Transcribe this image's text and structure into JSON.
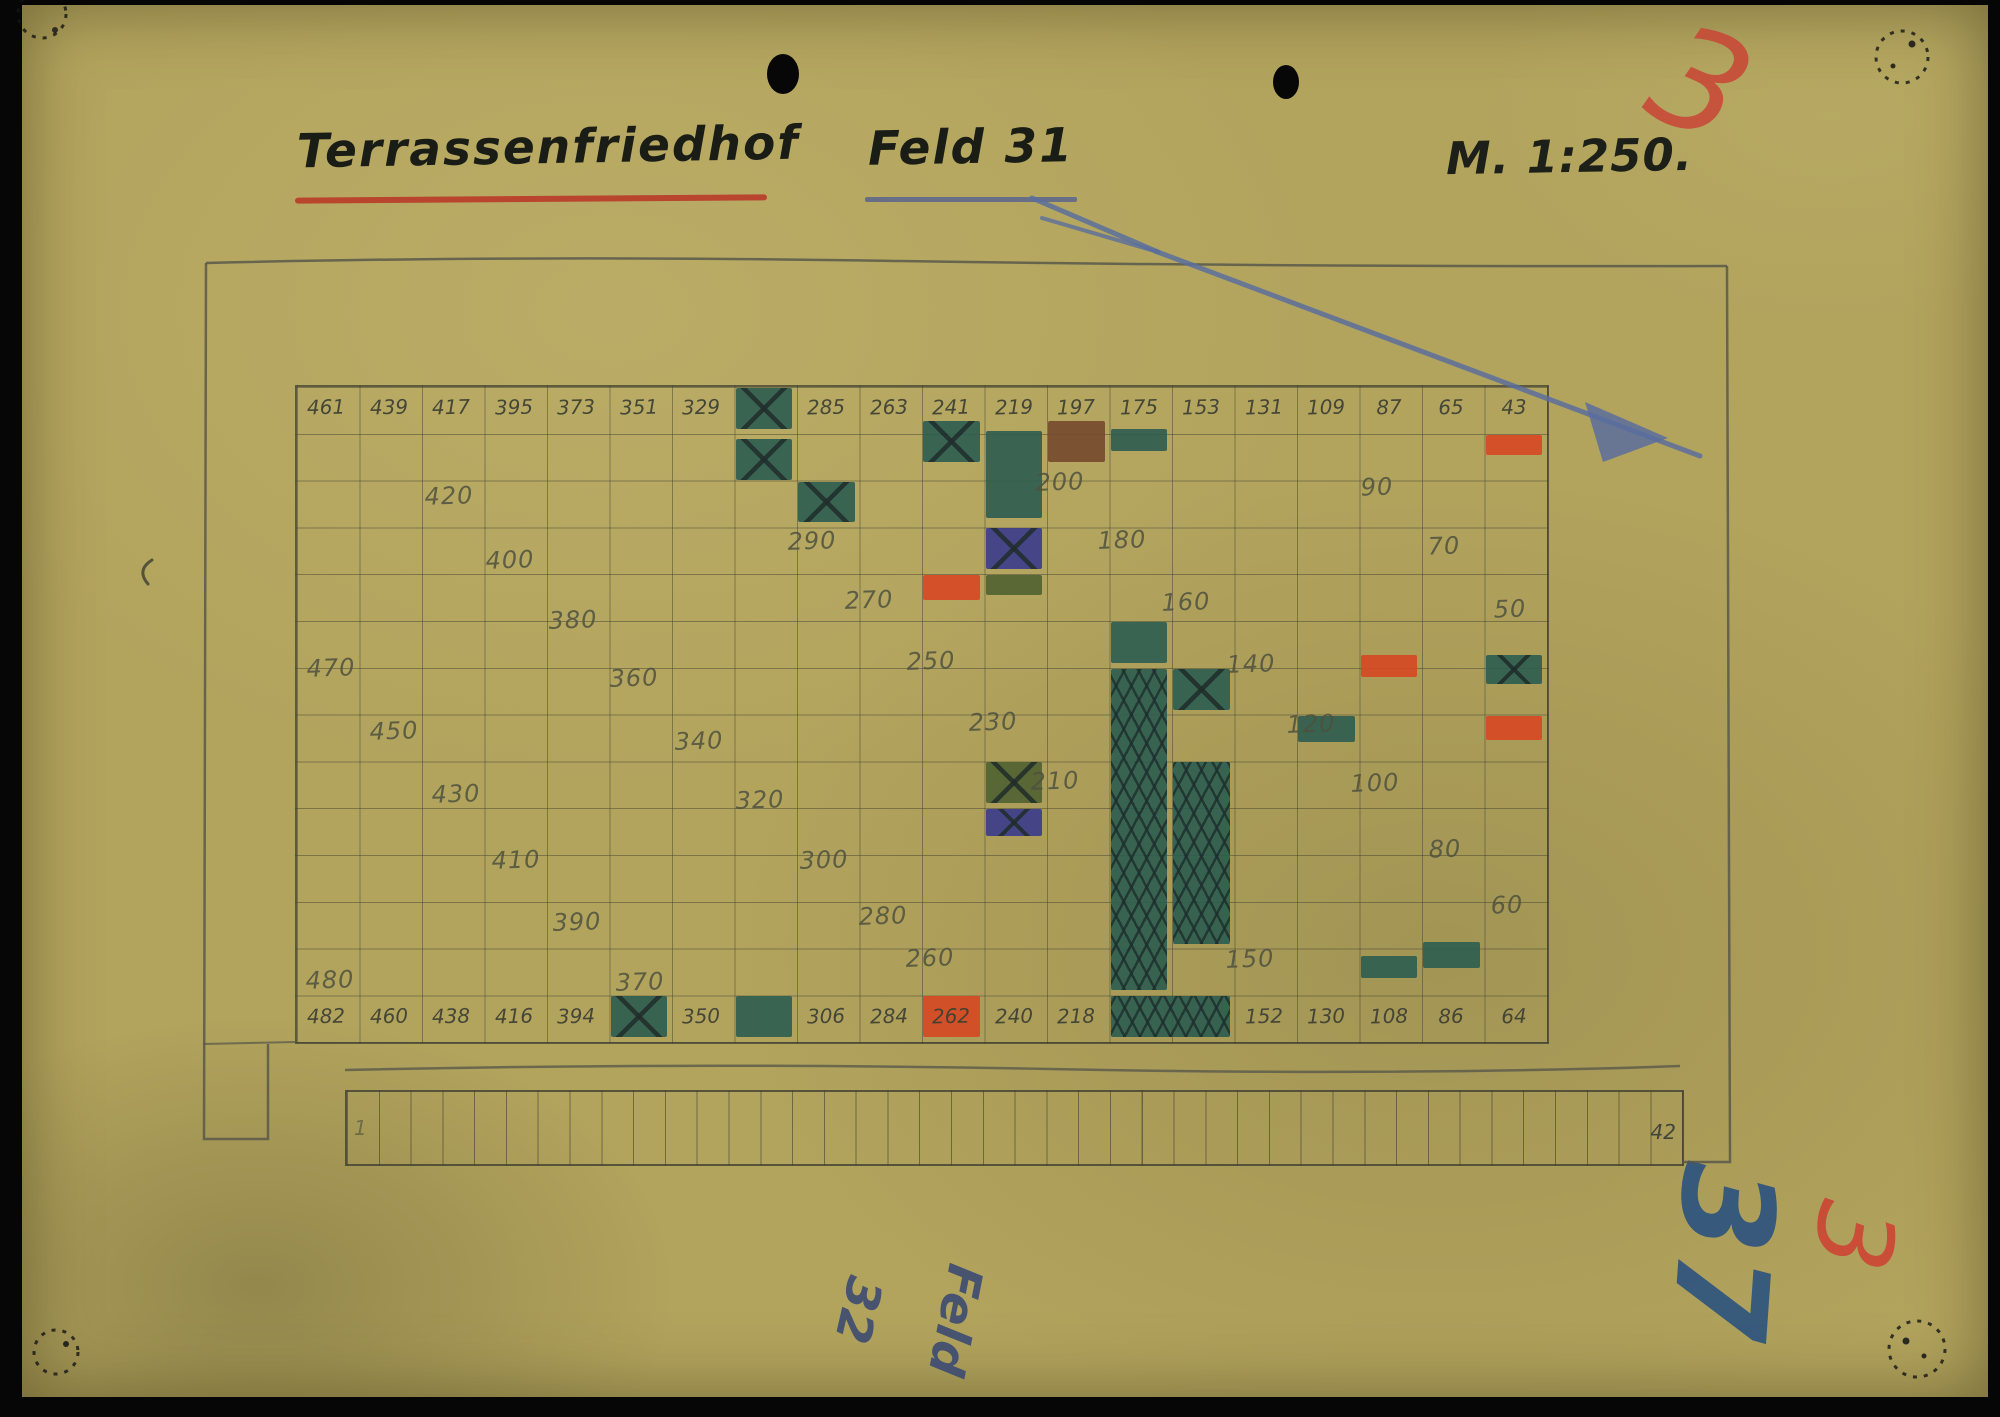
{
  "document": {
    "title": "Terrassenfriedhof",
    "field_label": "Feld 31",
    "scale_label": "M. 1:250.",
    "page_number_red_top": "3",
    "adjacent_field_word": "Feld",
    "adjacent_field_number": "32",
    "page_number_blue_bottom": "37",
    "page_number_red_bottom": "3"
  },
  "grid": {
    "columns": 20,
    "rows": 14,
    "header_numbers": [
      "461",
      "439",
      "417",
      "395",
      "373",
      "351",
      "329",
      "",
      "285",
      "263",
      "241",
      "219",
      "197",
      "175",
      "153",
      "131",
      "109",
      "87",
      "65",
      "43"
    ],
    "footer_numbers": [
      "482",
      "460",
      "438",
      "416",
      "394",
      "",
      "350",
      "",
      "306",
      "284",
      "262",
      "240",
      "218",
      "",
      "",
      "152",
      "130",
      "108",
      "86",
      "64"
    ],
    "interior_labels": [
      {
        "t": "420",
        "x": 449,
        "y": 496
      },
      {
        "t": "400",
        "x": 510,
        "y": 560
      },
      {
        "t": "380",
        "x": 573,
        "y": 620
      },
      {
        "t": "360",
        "x": 634,
        "y": 678
      },
      {
        "t": "340",
        "x": 699,
        "y": 741
      },
      {
        "t": "320",
        "x": 760,
        "y": 800
      },
      {
        "t": "300",
        "x": 824,
        "y": 860
      },
      {
        "t": "280",
        "x": 883,
        "y": 916
      },
      {
        "t": "260",
        "x": 930,
        "y": 958
      },
      {
        "t": "470",
        "x": 331,
        "y": 668
      },
      {
        "t": "450",
        "x": 394,
        "y": 731
      },
      {
        "t": "430",
        "x": 456,
        "y": 794
      },
      {
        "t": "410",
        "x": 516,
        "y": 860
      },
      {
        "t": "390",
        "x": 577,
        "y": 922
      },
      {
        "t": "370",
        "x": 640,
        "y": 982
      },
      {
        "t": "480",
        "x": 330,
        "y": 980
      },
      {
        "t": "290",
        "x": 812,
        "y": 541
      },
      {
        "t": "270",
        "x": 869,
        "y": 600
      },
      {
        "t": "250",
        "x": 931,
        "y": 661
      },
      {
        "t": "230",
        "x": 993,
        "y": 722
      },
      {
        "t": "210",
        "x": 1055,
        "y": 781
      },
      {
        "t": "200",
        "x": 1060,
        "y": 482
      },
      {
        "t": "180",
        "x": 1122,
        "y": 540
      },
      {
        "t": "160",
        "x": 1186,
        "y": 602
      },
      {
        "t": "140",
        "x": 1251,
        "y": 664
      },
      {
        "t": "120",
        "x": 1311,
        "y": 724
      },
      {
        "t": "100",
        "x": 1375,
        "y": 783
      },
      {
        "t": "80",
        "x": 1445,
        "y": 849
      },
      {
        "t": "60",
        "x": 1507,
        "y": 905
      },
      {
        "t": "150",
        "x": 1250,
        "y": 959
      },
      {
        "t": "90",
        "x": 1377,
        "y": 487
      },
      {
        "t": "70",
        "x": 1444,
        "y": 546
      },
      {
        "t": "50",
        "x": 1510,
        "y": 609
      }
    ],
    "colored_cells": [
      {
        "c": 8,
        "r": 1,
        "color": "green",
        "pat": "x"
      },
      {
        "c": 8,
        "r": 2,
        "color": "green",
        "pat": "x",
        "dy": 4
      },
      {
        "c": 9,
        "r": 3,
        "color": "green",
        "pat": "x"
      },
      {
        "c": 11,
        "r": 2,
        "color": "green",
        "pat": "x",
        "dy": -14
      },
      {
        "c": 12,
        "r": 2,
        "rs": 2,
        "color": "green",
        "dy": -4
      },
      {
        "c": 12,
        "r": 4,
        "color": "blue",
        "pat": "x"
      },
      {
        "c": 12,
        "r": 5,
        "color": "olive",
        "hf": 0.55
      },
      {
        "c": 13,
        "r": 2,
        "color": "brown",
        "dy": -14
      },
      {
        "c": 14,
        "r": 2,
        "color": "green",
        "dy": -6,
        "hf": 0.6
      },
      {
        "c": 11,
        "r": 5,
        "color": "red",
        "hf": 0.65
      },
      {
        "c": 20,
        "r": 2,
        "color": "red",
        "hf": 0.55
      },
      {
        "c": 18,
        "r": 7,
        "color": "red",
        "dy": -14,
        "hf": 0.6
      },
      {
        "c": 20,
        "r": 7,
        "color": "green",
        "pat": "x",
        "dy": -14,
        "hf": 0.75
      },
      {
        "c": 17,
        "r": 8,
        "color": "green",
        "hf": 0.7
      },
      {
        "c": 20,
        "r": 8,
        "color": "red",
        "hf": 0.65
      },
      {
        "c": 12,
        "r": 9,
        "color": "olive",
        "pat": "x"
      },
      {
        "c": 12,
        "r": 10,
        "color": "blue",
        "pat": "x",
        "hf": 0.7
      },
      {
        "c": 14,
        "r": 6,
        "color": "green"
      },
      {
        "c": 14,
        "r": 7,
        "rs": 7,
        "color": "green",
        "pat": "hatch"
      },
      {
        "c": 15,
        "r": 7,
        "color": "green",
        "pat": "x"
      },
      {
        "c": 15,
        "r": 9,
        "rs": 4,
        "color": "green",
        "pat": "hatch"
      },
      {
        "c": 18,
        "r": 13,
        "color": "green",
        "dy": 6,
        "hf": 0.6
      },
      {
        "c": 19,
        "r": 13,
        "color": "green",
        "dy": -8,
        "hf": 0.7
      },
      {
        "c": 6,
        "r": 14,
        "color": "green",
        "pat": "x"
      },
      {
        "c": 8,
        "r": 14,
        "color": "green"
      },
      {
        "c": 11,
        "r": 14,
        "color": "red"
      },
      {
        "c": 14,
        "r": 14,
        "cs": 2,
        "color": "green",
        "pat": "hatchx"
      }
    ]
  },
  "strip": {
    "cells": 42,
    "first_label": "1",
    "last_label": "42"
  },
  "colors": {
    "paper": "#b2a45d",
    "pencil": "#4e513e",
    "green": "#2c5d50",
    "olive": "#4f6231",
    "red": "#d64722",
    "blue": "#3a3b8c",
    "brown": "#744a2e",
    "arrow_blue": "#5a6e9e",
    "title_red_underline": "#b93a28",
    "title_blue_underline": "#59648c",
    "red_mark": "#c84a38",
    "blue_mark": "#2e547e"
  }
}
